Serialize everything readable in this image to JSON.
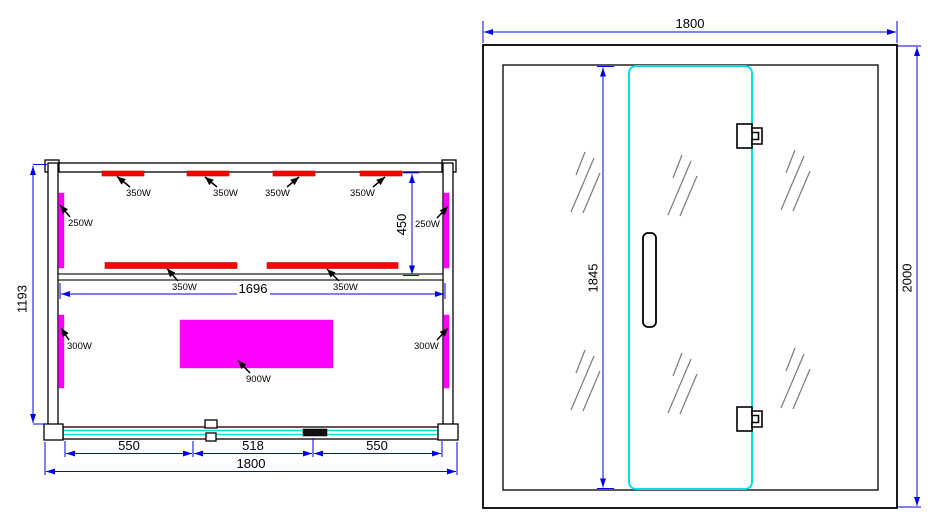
{
  "drawing": {
    "plan_view": {
      "top_heaters": [
        {
          "label": "350W"
        },
        {
          "label": "350W"
        },
        {
          "label": "350W"
        },
        {
          "label": "350W"
        }
      ],
      "mid_heaters": [
        {
          "label": "350W"
        },
        {
          "label": "350W"
        }
      ],
      "side_heaters_upper": [
        {
          "label": "250W"
        },
        {
          "label": "250W"
        }
      ],
      "side_heaters_lower": [
        {
          "label": "300W"
        },
        {
          "label": "300W"
        }
      ],
      "floor_heater": {
        "label": "900W"
      },
      "dimensions": {
        "depth": "1193",
        "heater_zone": "450",
        "inner_width": "1696",
        "front_left": "550",
        "front_center": "518",
        "front_right": "550",
        "overall_width": "1800"
      }
    },
    "front_view": {
      "dimensions": {
        "width": "1800",
        "door_height": "1845",
        "height": "2000"
      }
    },
    "colors": {
      "dimension_blue": "#0000ee",
      "heater_red": "#ff0000",
      "heater_magenta": "#ff00ff",
      "glass_cyan": "#00e0e0",
      "hatch_gray": "#7a7a7a",
      "line_black": "#000000"
    }
  }
}
